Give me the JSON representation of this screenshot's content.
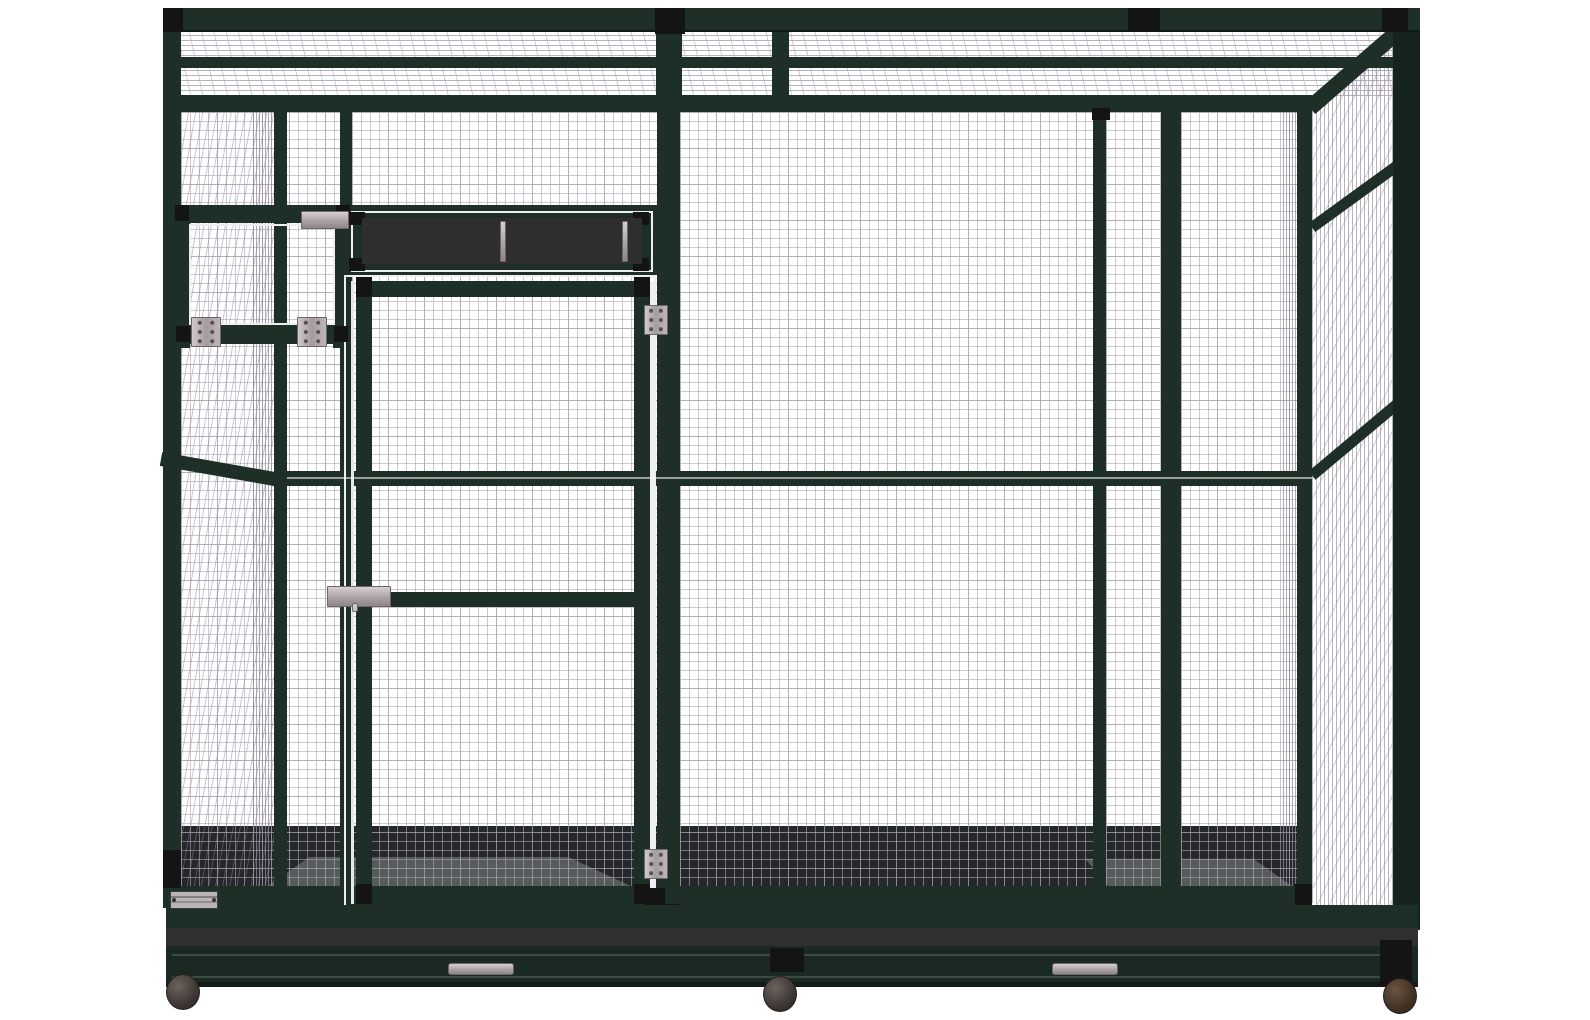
{
  "title": "Large walk-in aviary bird cage — front product render",
  "palette": {
    "background": "#ffffff",
    "frame_green": "#1d2f27",
    "frame_green_deep": "#16241e",
    "joint_black": "#141414",
    "mesh_line": "#aba3b2",
    "interior_dark": "#24282b",
    "tray_gray": "#303032",
    "hardware_silver": "#bdb6b8",
    "caster_brown": "#4e3c2c"
  },
  "structure": {
    "roof": {
      "label": "wire mesh roof seen in perspective",
      "purlin_count": 1
    },
    "front": {
      "label": "front mesh elevation with dark green frame",
      "panel_count": 5,
      "mid_rail": true,
      "door": {
        "label": "hinged walk-in mesh door",
        "hinges": 2,
        "latch": "slide bolt",
        "rails": [
          "top",
          "mid",
          "lock",
          "bottom"
        ]
      },
      "transom": {
        "label": "dark service opening above door",
        "support_bars": 2
      },
      "feed_hatch": {
        "label": "drop-down feeder hatch",
        "hinges": 2,
        "latch": "slide latch"
      }
    },
    "right_side": {
      "label": "mesh side wall in perspective",
      "rails": 2
    },
    "base": {
      "label": "seed-tray base with pull-out trays",
      "tray_band": true,
      "handles": 2,
      "casters": 3,
      "nameplate": {
        "label": "manufacturer nameplate",
        "text": ""
      }
    }
  }
}
